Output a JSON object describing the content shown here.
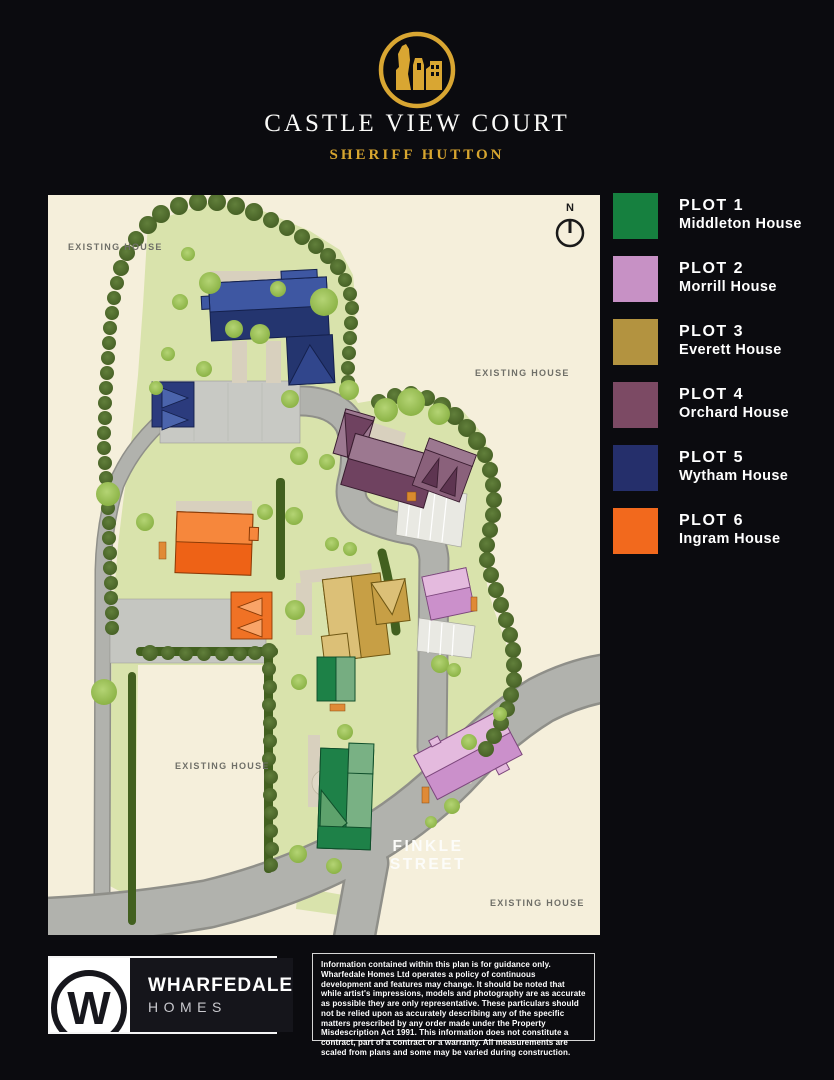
{
  "header": {
    "title": "CASTLE VIEW COURT",
    "subtitle": "SHERIFF HUTTON",
    "logo_color": "#D9A632"
  },
  "legend": {
    "items": [
      {
        "plot": "PLOT 1",
        "name": "Middleton House",
        "color": "#16803F"
      },
      {
        "plot": "PLOT 2",
        "name": "Morrill House",
        "color": "#C791C5"
      },
      {
        "plot": "PLOT 3",
        "name": "Everett House",
        "color": "#B39340"
      },
      {
        "plot": "PLOT 4",
        "name": "Orchard House",
        "color": "#7C4A64"
      },
      {
        "plot": "PLOT 5",
        "name": "Wytham House",
        "color": "#252F6B"
      },
      {
        "plot": "PLOT 6",
        "name": "Ingram House",
        "color": "#F2691D"
      }
    ]
  },
  "map": {
    "labels": {
      "existing_house": "EXISTING HOUSE",
      "street_line1": "FINKLE",
      "street_line2": "STREET",
      "compass_north": "N"
    }
  },
  "footer": {
    "brand": {
      "monogram": "W",
      "name": "WHARFEDALE",
      "type": "HOMES"
    },
    "disclaimer": "Information contained within this plan is for guidance only. Wharfedale Homes Ltd operates a policy of continuous development and features may change. It should be noted that while artist's impressions, models and photography are as accurate as possible they are only representative. These particulars should not be relied upon as accurately describing any of the specific matters prescribed by any order made under the Property Misdescription Act 1991. This information does not constitute a contract, part of a contract or a warranty. All measurements are scaled from plans and some may be varied during construction."
  }
}
